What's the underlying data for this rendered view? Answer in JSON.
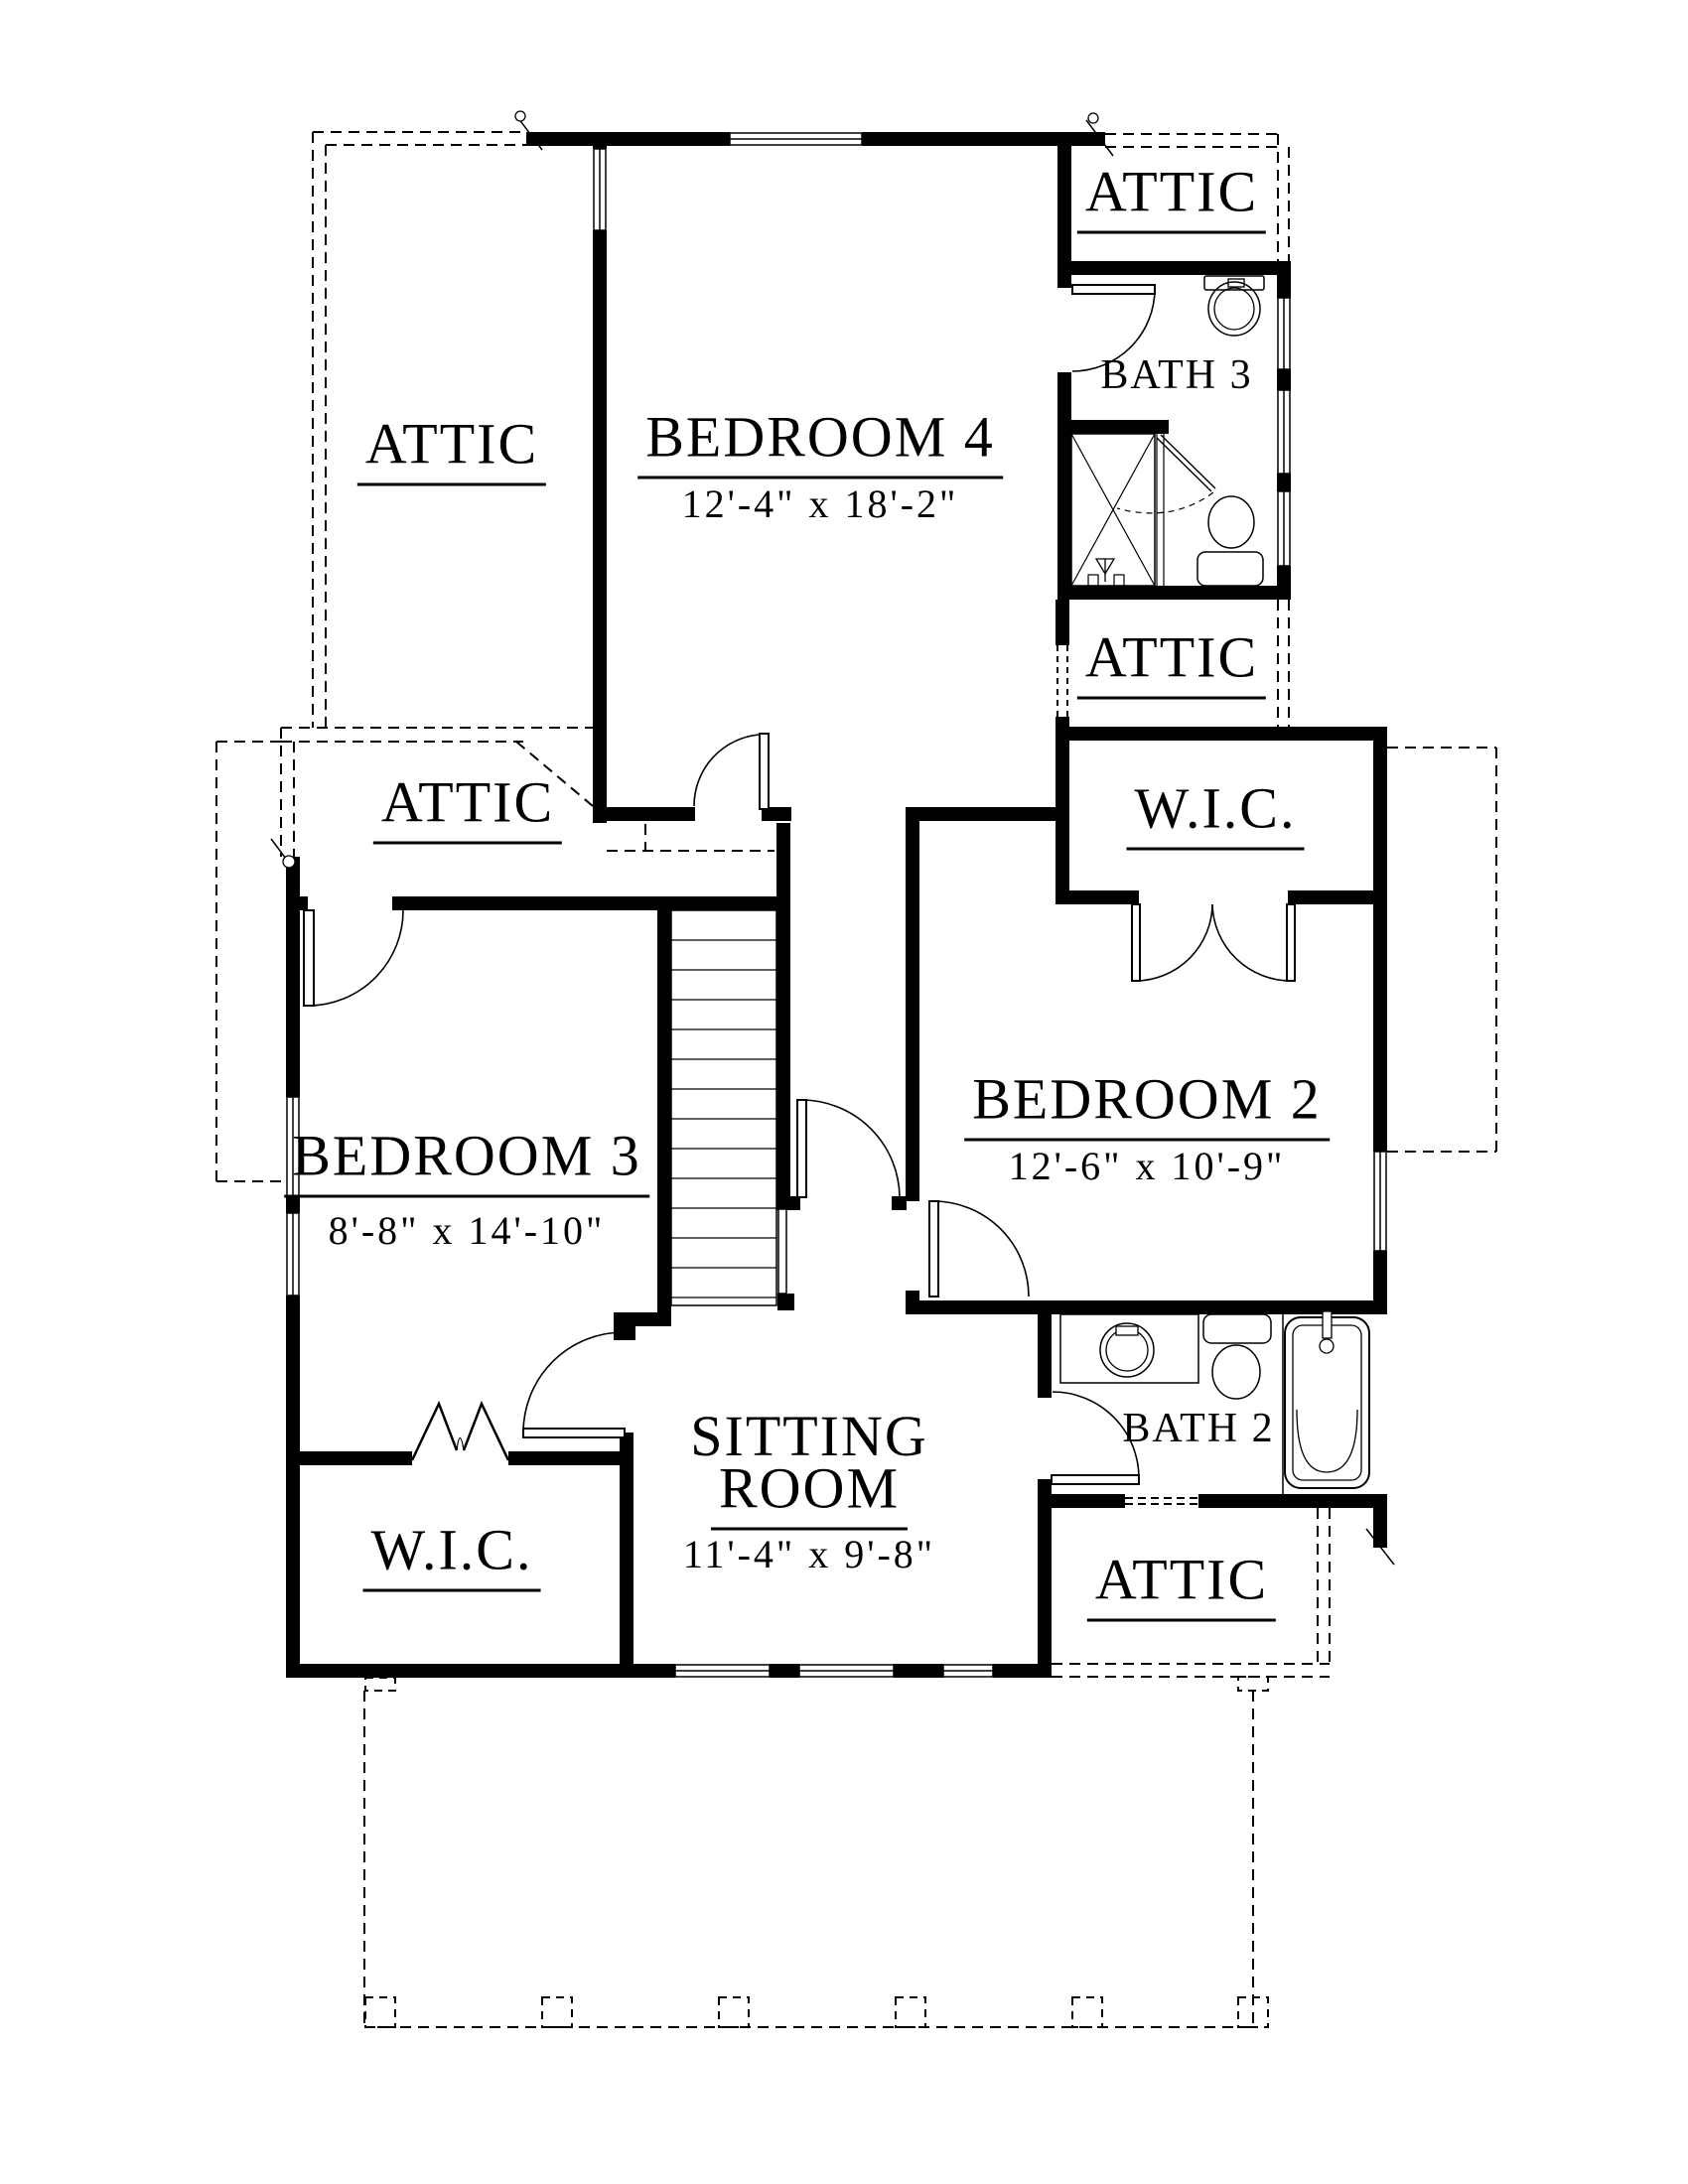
{
  "colors": {
    "ink": "#000000",
    "paper": "#ffffff"
  },
  "rooms": {
    "attic_top_right": {
      "label": "ATTIC"
    },
    "bedroom_4": {
      "label": "BEDROOM 4",
      "dims": "12'-4\" x 18'-2\""
    },
    "bath_3": {
      "label": "BATH 3"
    },
    "attic_left": {
      "label": "ATTIC"
    },
    "attic_mid_right": {
      "label": "ATTIC"
    },
    "attic_left_small": {
      "label": "ATTIC"
    },
    "wic_right": {
      "label": "W.I.C."
    },
    "bedroom_2": {
      "label": "BEDROOM 2",
      "dims": "12'-6\" x 10'-9\""
    },
    "bedroom_3": {
      "label": "BEDROOM 3",
      "dims": "8'-8\" x 14'-10\""
    },
    "sitting_room": {
      "label_line_1": "SITTING",
      "label_line_2": "ROOM",
      "dims": "11'-4\" x 9'-8\""
    },
    "bath_2": {
      "label": "BATH 2"
    },
    "wic_left": {
      "label": "W.I.C."
    },
    "attic_bottom_right": {
      "label": "ATTIC"
    }
  }
}
